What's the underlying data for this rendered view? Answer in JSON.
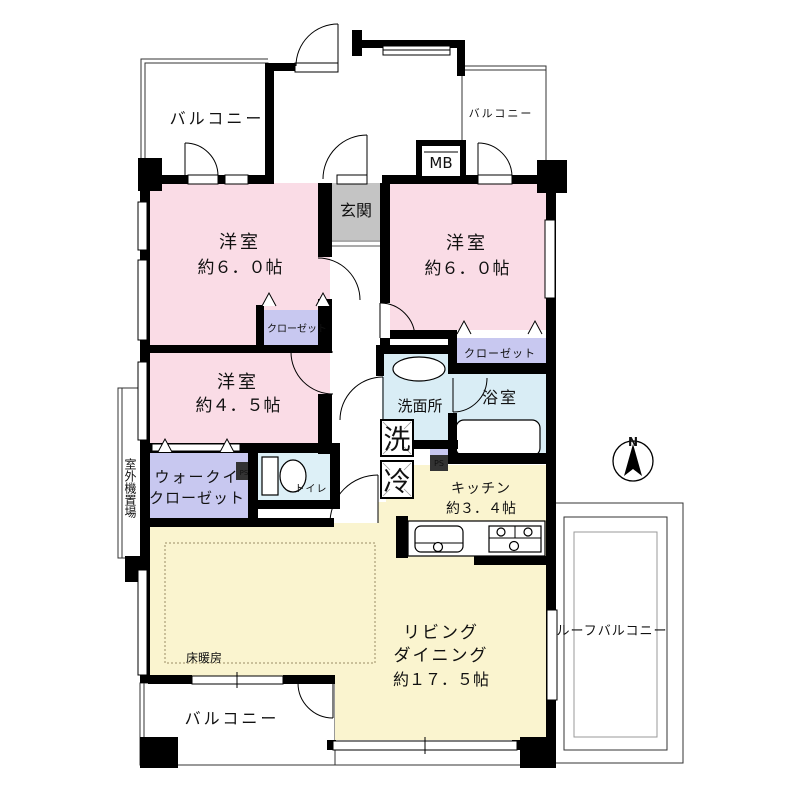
{
  "floorplan": {
    "compass_label": "N",
    "rooms": {
      "balcony_top_left": "バルコニー",
      "balcony_top_right": "バルコニー",
      "balcony_bottom": "バルコニー",
      "roof_balcony": "ルーフバルコニー",
      "entrance": "玄関",
      "meter_box": "MB",
      "bedroom_left_name": "洋室",
      "bedroom_left_size": "約６．０帖",
      "bedroom_right_name": "洋室",
      "bedroom_right_size": "約６．０帖",
      "bedroom_small_name": "洋室",
      "bedroom_small_size": "約４．５帖",
      "closet_left": "クローゼット",
      "closet_right": "クローゼット",
      "walk_in_closet_line1": "ウォークイ",
      "walk_in_closet_line2": "クローゼット",
      "washroom": "洗面所",
      "bathroom": "浴室",
      "toilet": "トイレ",
      "washer": "洗",
      "fridge": "冷",
      "pipe_space_1": "PS",
      "pipe_space_2": "PS",
      "kitchen_name": "キッチン",
      "kitchen_size": "約３．４帖",
      "living_name_line1": "リビング",
      "living_name_line2": "ダイニング",
      "living_size": "約１７．５帖",
      "floor_heating": "床暖房",
      "outdoor_unit": "室外機置場"
    },
    "colors": {
      "bedroom": "#fadce6",
      "closet": "#c8c8f0",
      "wet_area": "#d9edf5",
      "toilet_area": "#ddf0f7",
      "living": "#faf4cf",
      "entrance": "#c4c4c4",
      "wall": "#000000"
    }
  }
}
